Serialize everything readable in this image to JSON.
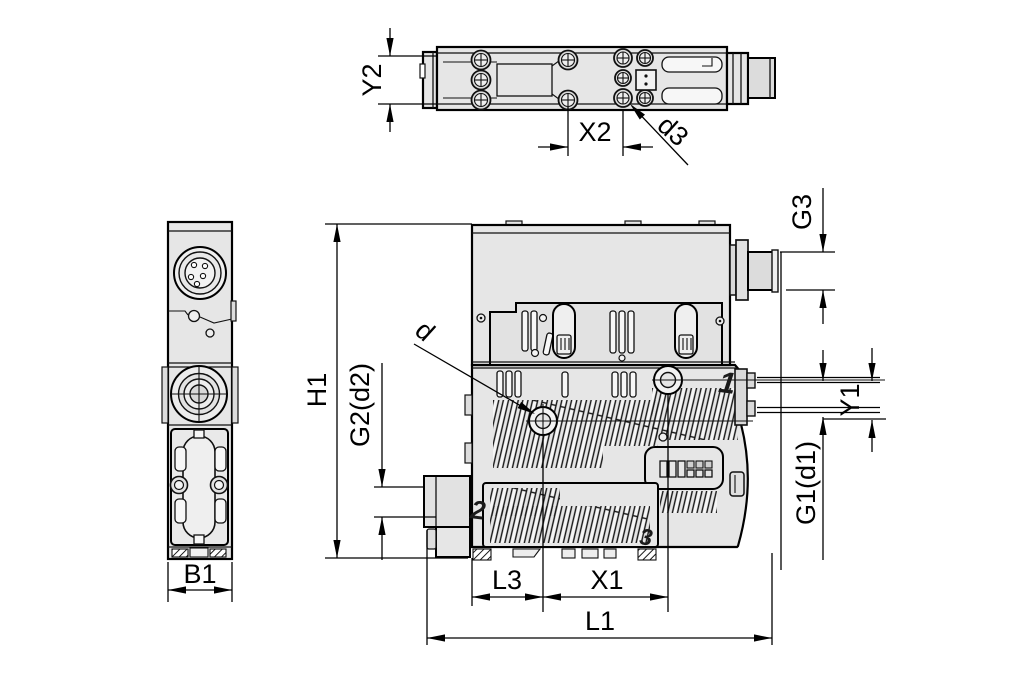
{
  "drawing": {
    "type": "technical-dimension-drawing",
    "views": {
      "top": "top-view",
      "side": "side-view",
      "front": "front-view"
    },
    "labels": {
      "y2": "Y2",
      "x2": "X2",
      "d3": "d3",
      "h1": "H1",
      "g2_d2": "G2(d2)",
      "d": "d",
      "b1": "B1",
      "l3": "L3",
      "x1": "X1",
      "l1": "L1",
      "g3": "G3",
      "y1": "Y1",
      "g1_d1": "G1(d1)"
    },
    "port_markings": {
      "p1": "1",
      "p2": "2",
      "p3": "3"
    },
    "colors": {
      "line": "#000000",
      "body_fill": "#e6e6e6",
      "barrel_fill": "#dcdcdc",
      "background": "#ffffff"
    }
  }
}
